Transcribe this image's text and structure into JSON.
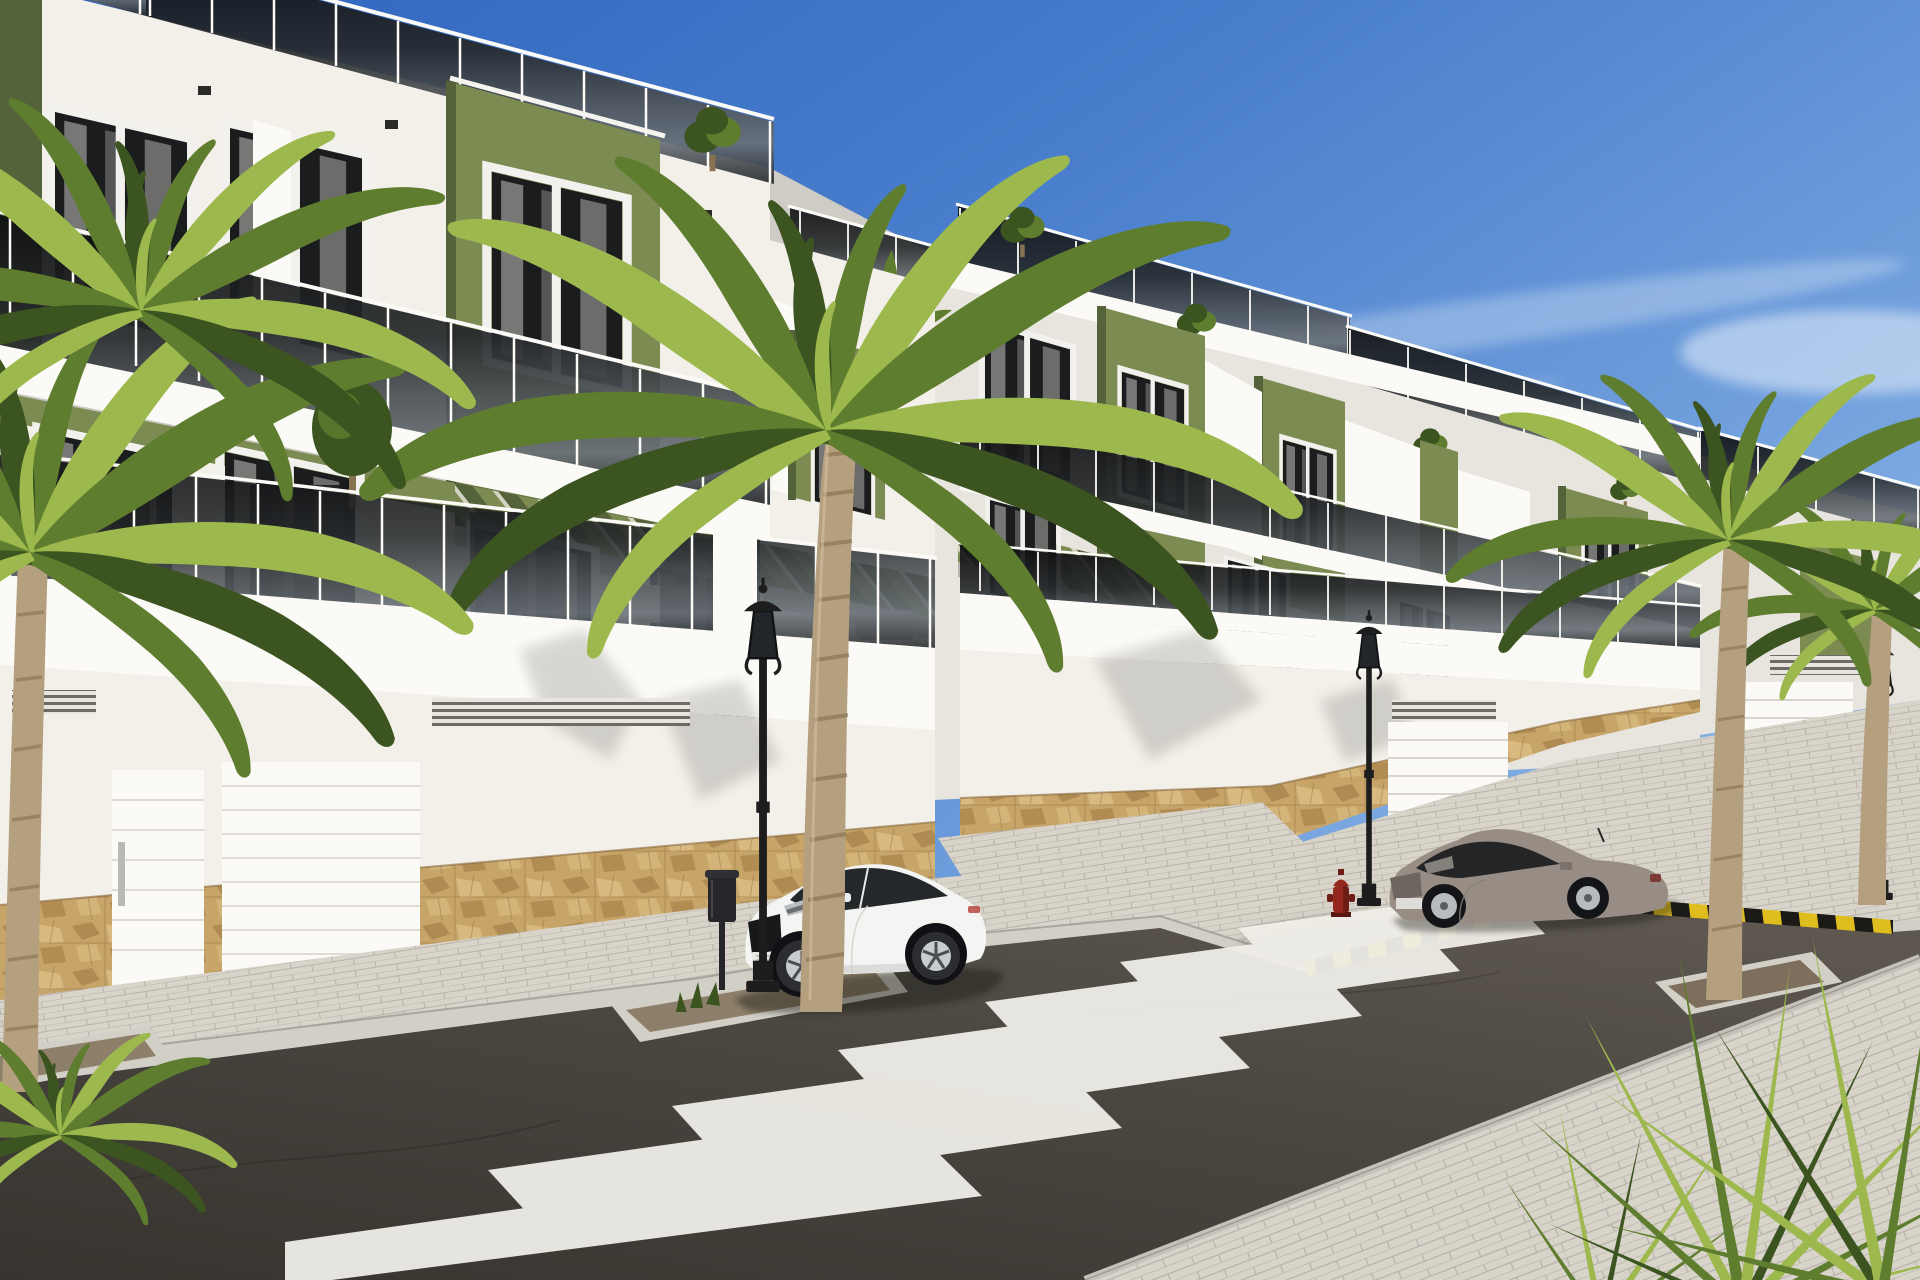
{
  "meta": {
    "width": 1920,
    "height": 1280
  },
  "scene": {
    "setting": "Sunny street-level render of new-build white apartments with olive green facade panels, tinted glass balconies, rooftop terraces, palm trees and two parked cars",
    "sky": "clear blue sky with thin white clouds",
    "objects": [
      "apartment-building-left",
      "apartment-building-right",
      "rooftop-glass-railings",
      "olive-green-facade-panels",
      "tinted-glass-balconies",
      "green-louver-pergolas",
      "garage-doors",
      "pedestrian-door",
      "stone-clad-base",
      "ventilation-grilles",
      "white-coupe-car",
      "gray-hatchback-car",
      "ornate-street-lamps",
      "litter-bin",
      "red-fire-hydrant",
      "palm-trees",
      "zebra-crossing",
      "yellow-black-kerb-marking",
      "paved-sidewalks",
      "asphalt-road",
      "tree-planting-pits",
      "rooftop-shrubs"
    ],
    "vehicles": [
      {
        "name": "white-coupe",
        "body_color": "#f4f4f3",
        "position": "parked at left kerb"
      },
      {
        "name": "gray-hatchback",
        "body_color": "#978d84",
        "position": "parked at right kerb"
      }
    ],
    "counts": {
      "street_lamps": 3,
      "cars": 2,
      "palm_trees": 5,
      "crosswalk_stripes": 7,
      "garage_doors": 4
    }
  },
  "colors": {
    "sky_top": "#2d63bd",
    "sky_mid": "#4a7fcd",
    "sky_mid2": "#7aa7e0",
    "sky_low": "#b9d4ef",
    "cloud_white": "#eef5fc",
    "wall_bright": "#f3f0ea",
    "wall_light": "#e8e4de",
    "wall_mid": "#cfccc6",
    "wall_shade": "#b4b1ab",
    "fascia_white": "#fbfaf6",
    "green_light": "#9aa86b",
    "green_mid": "#7c8b52",
    "green_dark": "#55633a",
    "glass_dark": "#0d0e10",
    "glass_mid": "#26292b",
    "glass_light": "#4b5054",
    "glass_reflect": "#697077",
    "window_dark": "#1b1c1e",
    "curtain": "#8f8e8c",
    "frame_white": "#f2f1ee",
    "stone_base": "#c7a468",
    "stone_dark": "#96713d",
    "stone_light": "#e2c78f",
    "stone_line": "#7a5c33",
    "pavement": "#d8d4ca",
    "pavement_shade": "#b7b3aa",
    "curb": "#d2cfc7",
    "gravel": "#8d7f6a",
    "asphalt_dark": "#37342f",
    "asphalt_mid": "#49453f",
    "asphalt_light": "#5d574f",
    "stripe_white": "#f1efe9",
    "marking_yellow": "#e0bd1e",
    "marking_black": "#1c1a17",
    "hydrant_red": "#93271c",
    "lamp_black": "#1d1d1d",
    "bin_black": "#26262a",
    "car_white": "#f4f4f3",
    "car_glass": "#25282a",
    "car_gray": "#978d84",
    "trunk": "#b49f7f",
    "trunk_dark": "#87714f",
    "palm_green": "#5f7d2e",
    "palm_green_dark": "#3c5420",
    "palm_green_light": "#9db94e",
    "shadow_tint": "#1c1a17"
  }
}
